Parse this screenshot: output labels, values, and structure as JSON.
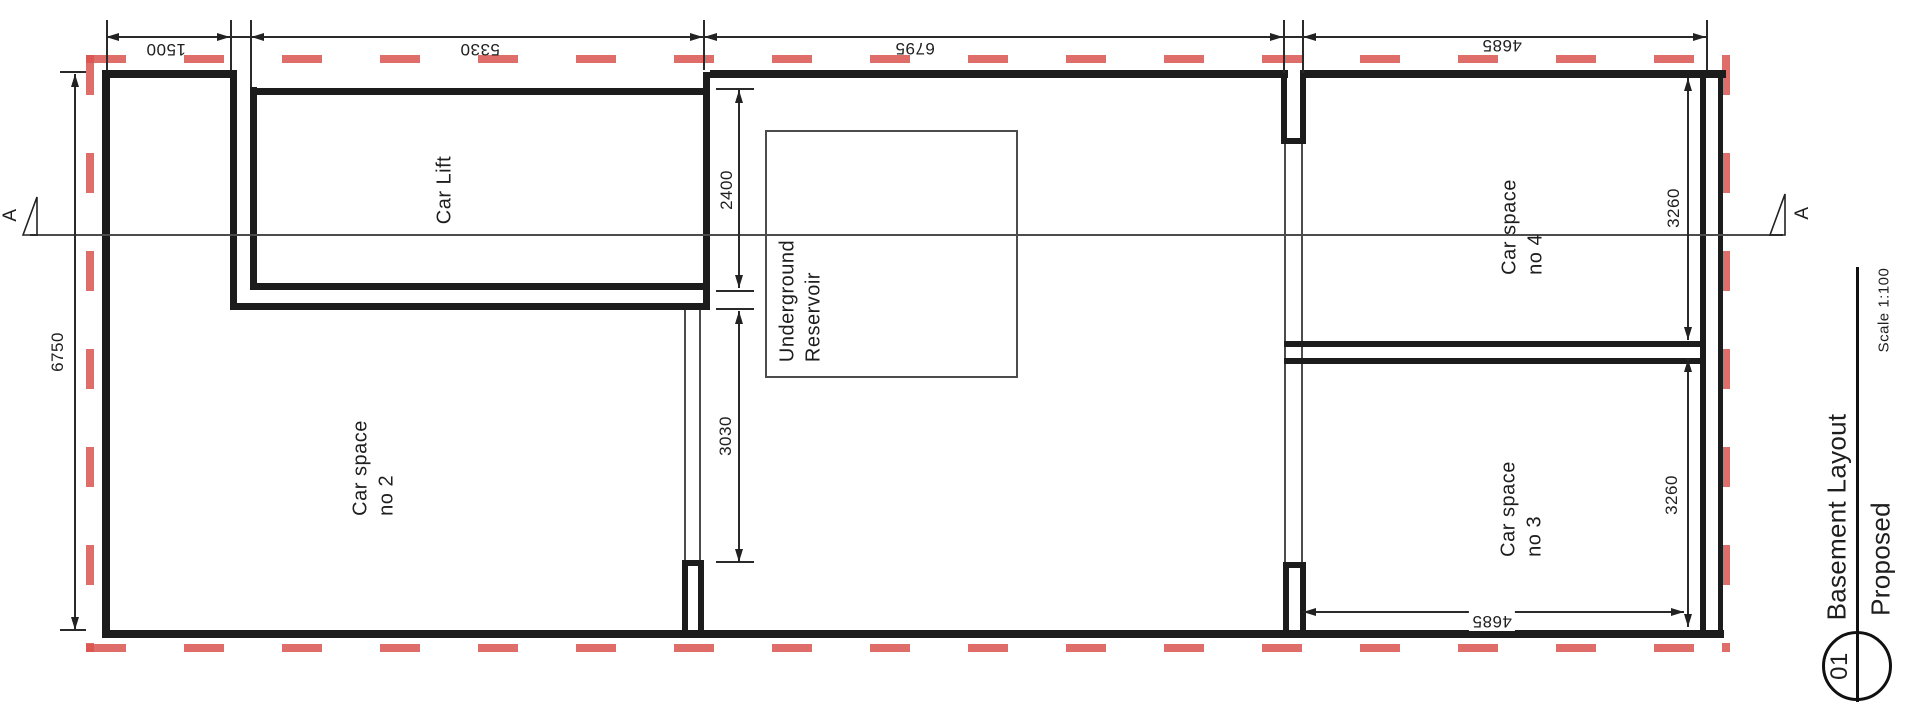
{
  "rooms": {
    "car_lift": "Car Lift",
    "car_space_2": {
      "l1": "Car space",
      "l2": "no 2"
    },
    "car_space_3": {
      "l1": "Car space",
      "l2": "no 3"
    },
    "car_space_4": {
      "l1": "Car space",
      "l2": "no 4"
    },
    "reservoir": {
      "l1": "Underground",
      "l2": "Reservoir"
    }
  },
  "dimensions": {
    "top": {
      "d1": "1500",
      "d2": "5330",
      "d3": "6795",
      "d4": "4685"
    },
    "left": "6750",
    "inner": {
      "d1": "2400",
      "d2": "3030"
    },
    "right": {
      "d1": "3260",
      "d2": "3260"
    },
    "bottom": "4685"
  },
  "section": {
    "left_label": "A",
    "right_label": "A"
  },
  "title_block": {
    "number": "01",
    "title": "Basement Layout",
    "status": "Proposed",
    "scale": "Scale 1:100"
  },
  "colors": {
    "hatch": "#d9534f",
    "wall": "#1c1c1c",
    "thin": "#4c4c4c"
  }
}
